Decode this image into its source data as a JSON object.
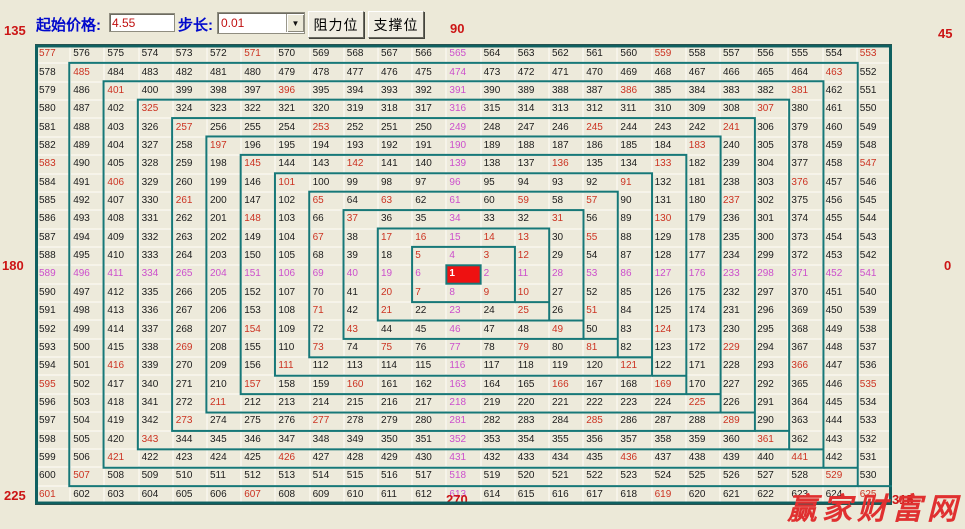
{
  "toolbar": {
    "start_price_label": "起始价格:",
    "start_price_value": "4.55",
    "step_label": "步长:",
    "step_value": "0.01",
    "dropdown_arrow": "▼",
    "resistance_button": "阻力位",
    "support_button": "支撑位"
  },
  "angle_labels": {
    "top_left": "135",
    "top": "90",
    "top_right": "45",
    "left": "180",
    "right": "0",
    "bottom_left": "225",
    "bottom": "270",
    "bottom_right": "315"
  },
  "watermark": "赢家财富网",
  "colors": {
    "background": "#ece9d8",
    "cell_bg": "#edeadb",
    "number_black": "#1c1c1c",
    "number_red": "#cc3322",
    "number_magenta": "#cc4fcc",
    "center_bg": "#ee1111",
    "center_text": "#ffffff",
    "spiral": "#177878",
    "spiral_outer": "#0f6060",
    "label_red": "#cc1515",
    "label_blue": "#0008cc",
    "watermark_red": "#e03030"
  },
  "grid": {
    "size": 25,
    "center_value": 1,
    "rows": [
      [
        577,
        576,
        575,
        574,
        573,
        572,
        571,
        570,
        569,
        568,
        567,
        566,
        565,
        564,
        563,
        562,
        561,
        560,
        559,
        558,
        557,
        556,
        555,
        554,
        553
      ],
      [
        578,
        485,
        484,
        483,
        482,
        481,
        480,
        479,
        478,
        477,
        476,
        475,
        474,
        473,
        472,
        471,
        470,
        469,
        468,
        467,
        466,
        465,
        464,
        463,
        552
      ],
      [
        579,
        486,
        401,
        400,
        399,
        398,
        397,
        396,
        395,
        394,
        393,
        392,
        391,
        390,
        389,
        388,
        387,
        386,
        385,
        384,
        383,
        382,
        381,
        462,
        551
      ],
      [
        580,
        487,
        402,
        325,
        324,
        323,
        322,
        321,
        320,
        319,
        318,
        317,
        316,
        315,
        314,
        313,
        312,
        311,
        310,
        309,
        308,
        307,
        380,
        461,
        550
      ],
      [
        581,
        488,
        403,
        326,
        257,
        256,
        255,
        254,
        253,
        252,
        251,
        250,
        249,
        248,
        247,
        246,
        245,
        244,
        243,
        242,
        241,
        306,
        379,
        460,
        549
      ],
      [
        582,
        489,
        404,
        327,
        258,
        197,
        196,
        195,
        194,
        193,
        192,
        191,
        190,
        189,
        188,
        187,
        186,
        185,
        184,
        183,
        240,
        305,
        378,
        459,
        548
      ],
      [
        583,
        490,
        405,
        328,
        259,
        198,
        145,
        144,
        143,
        142,
        141,
        140,
        139,
        138,
        137,
        136,
        135,
        134,
        133,
        182,
        239,
        304,
        377,
        458,
        547
      ],
      [
        584,
        491,
        406,
        329,
        260,
        199,
        146,
        101,
        100,
        99,
        98,
        97,
        96,
        95,
        94,
        93,
        92,
        91,
        132,
        181,
        238,
        303,
        376,
        457,
        546
      ],
      [
        585,
        492,
        407,
        330,
        261,
        200,
        147,
        102,
        65,
        64,
        63,
        62,
        61,
        60,
        59,
        58,
        57,
        90,
        131,
        180,
        237,
        302,
        375,
        456,
        545
      ],
      [
        586,
        493,
        408,
        331,
        262,
        201,
        148,
        103,
        66,
        37,
        36,
        35,
        34,
        33,
        32,
        31,
        56,
        89,
        130,
        179,
        236,
        301,
        374,
        455,
        544
      ],
      [
        587,
        494,
        409,
        332,
        263,
        202,
        149,
        104,
        67,
        38,
        17,
        16,
        15,
        14,
        13,
        30,
        55,
        88,
        129,
        178,
        235,
        300,
        373,
        454,
        543
      ],
      [
        588,
        495,
        410,
        333,
        264,
        203,
        150,
        105,
        68,
        39,
        18,
        5,
        4,
        3,
        12,
        29,
        54,
        87,
        128,
        177,
        234,
        299,
        372,
        453,
        542
      ],
      [
        589,
        496,
        411,
        334,
        265,
        204,
        151,
        106,
        69,
        40,
        19,
        6,
        1,
        2,
        11,
        28,
        53,
        86,
        127,
        176,
        233,
        298,
        371,
        452,
        541
      ],
      [
        590,
        497,
        412,
        335,
        266,
        205,
        152,
        107,
        70,
        41,
        20,
        7,
        8,
        9,
        10,
        27,
        52,
        85,
        126,
        175,
        232,
        297,
        370,
        451,
        540
      ],
      [
        591,
        498,
        413,
        336,
        267,
        206,
        153,
        108,
        71,
        42,
        21,
        22,
        23,
        24,
        25,
        26,
        51,
        84,
        125,
        174,
        231,
        296,
        369,
        450,
        539
      ],
      [
        592,
        499,
        414,
        337,
        268,
        207,
        154,
        109,
        72,
        43,
        44,
        45,
        46,
        47,
        48,
        49,
        50,
        83,
        124,
        173,
        230,
        295,
        368,
        449,
        538
      ],
      [
        593,
        500,
        415,
        338,
        269,
        208,
        155,
        110,
        73,
        74,
        75,
        76,
        77,
        78,
        79,
        80,
        81,
        82,
        123,
        172,
        229,
        294,
        367,
        448,
        537
      ],
      [
        594,
        501,
        416,
        339,
        270,
        209,
        156,
        111,
        112,
        113,
        114,
        115,
        116,
        117,
        118,
        119,
        120,
        121,
        122,
        171,
        228,
        293,
        366,
        447,
        536
      ],
      [
        595,
        502,
        417,
        340,
        271,
        210,
        157,
        158,
        159,
        160,
        161,
        162,
        163,
        164,
        165,
        166,
        167,
        168,
        169,
        170,
        227,
        292,
        365,
        446,
        535
      ],
      [
        596,
        503,
        418,
        341,
        272,
        211,
        212,
        213,
        214,
        215,
        216,
        217,
        218,
        219,
        220,
        221,
        222,
        223,
        224,
        225,
        226,
        291,
        364,
        445,
        534
      ],
      [
        597,
        504,
        419,
        342,
        273,
        274,
        275,
        276,
        277,
        278,
        279,
        280,
        281,
        282,
        283,
        284,
        285,
        286,
        287,
        288,
        289,
        290,
        363,
        444,
        533
      ],
      [
        598,
        505,
        420,
        343,
        344,
        345,
        346,
        347,
        348,
        349,
        350,
        351,
        352,
        353,
        354,
        355,
        356,
        357,
        358,
        359,
        360,
        361,
        362,
        443,
        532
      ],
      [
        599,
        506,
        421,
        422,
        423,
        424,
        425,
        426,
        427,
        428,
        429,
        430,
        431,
        432,
        433,
        434,
        435,
        436,
        437,
        438,
        439,
        440,
        441,
        442,
        531
      ],
      [
        600,
        507,
        508,
        509,
        510,
        511,
        512,
        513,
        514,
        515,
        516,
        517,
        518,
        519,
        520,
        521,
        522,
        523,
        524,
        525,
        526,
        527,
        528,
        529,
        530
      ],
      [
        601,
        602,
        603,
        604,
        605,
        606,
        607,
        608,
        609,
        610,
        611,
        612,
        613,
        614,
        615,
        616,
        617,
        618,
        619,
        620,
        621,
        622,
        623,
        624,
        625
      ]
    ],
    "red_values": [
      3,
      5,
      7,
      9,
      10,
      12,
      13,
      14,
      16,
      17,
      20,
      21,
      25,
      31,
      37,
      43,
      49,
      51,
      55,
      57,
      59,
      63,
      65,
      67,
      71,
      73,
      75,
      79,
      81,
      91,
      101,
      111,
      121,
      124,
      130,
      133,
      136,
      142,
      145,
      148,
      154,
      157,
      160,
      166,
      169,
      183,
      197,
      211,
      225,
      229,
      237,
      241,
      245,
      253,
      257,
      261,
      269,
      273,
      277,
      285,
      289,
      307,
      325,
      343,
      361,
      366,
      376,
      381,
      386,
      396,
      401,
      406,
      416,
      421,
      426,
      436,
      441,
      463,
      485,
      507,
      529,
      535,
      547,
      553,
      559,
      571,
      577,
      583,
      595,
      601,
      607,
      619,
      625
    ],
    "magenta_values": [
      2,
      4,
      6,
      8,
      11,
      15,
      19,
      23,
      28,
      34,
      40,
      46,
      53,
      61,
      69,
      77,
      86,
      96,
      106,
      116,
      127,
      139,
      151,
      163,
      176,
      190,
      204,
      218,
      233,
      249,
      265,
      281,
      298,
      316,
      334,
      352,
      371,
      391,
      411,
      431,
      452,
      474,
      496,
      518,
      541,
      565,
      589,
      613
    ]
  }
}
